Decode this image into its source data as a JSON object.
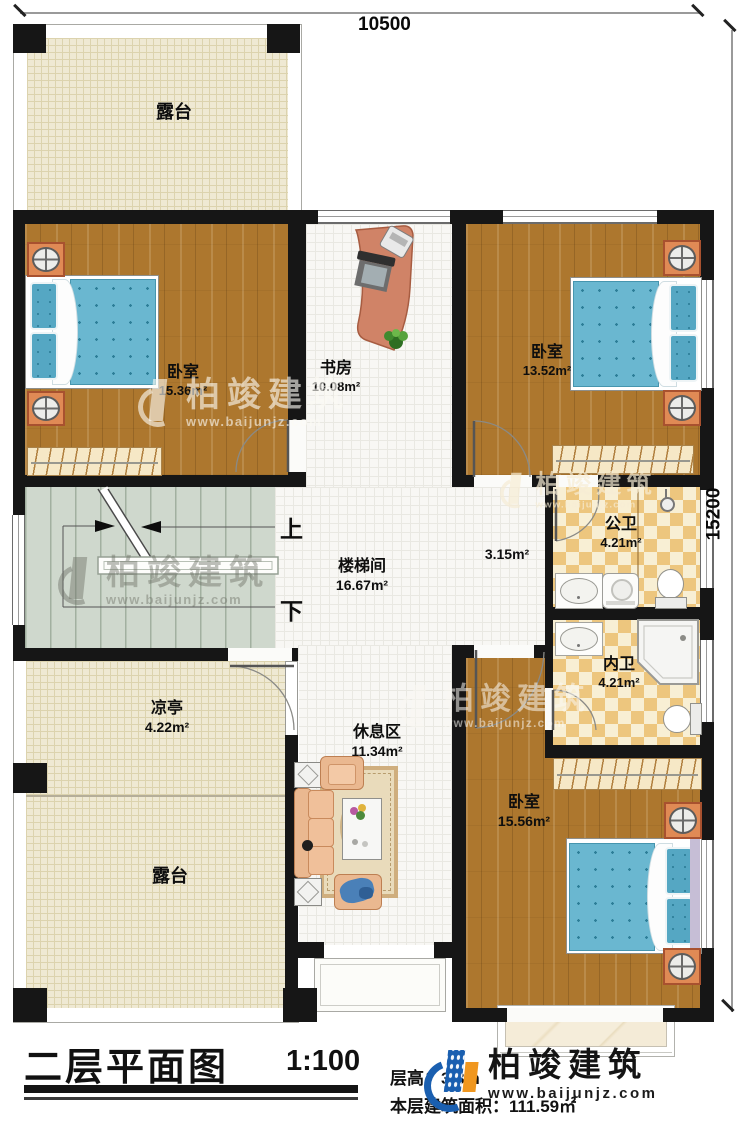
{
  "dimensions": {
    "top": "10500",
    "right": "15200"
  },
  "stairs": {
    "up": "上",
    "down": "下"
  },
  "rooms": {
    "terrace_top": {
      "name": "露台"
    },
    "bedroom_tl": {
      "name": "卧室",
      "area": "15.36m²"
    },
    "study": {
      "name": "书房",
      "area": "10.08m²"
    },
    "bedroom_tr": {
      "name": "卧室",
      "area": "13.52m²"
    },
    "stair_hall": {
      "name": "楼梯间",
      "area": "16.67m²"
    },
    "corridor": {
      "area": "3.15m²"
    },
    "public_bath": {
      "name": "公卫",
      "area": "4.21m²"
    },
    "private_bath": {
      "name": "内卫",
      "area": "4.21m²"
    },
    "pavilion": {
      "name": "凉亭",
      "area": "4.22m²"
    },
    "rest_area": {
      "name": "休息区",
      "area": "11.34m²"
    },
    "bedroom_br": {
      "name": "卧室",
      "area": "15.56m²"
    },
    "terrace_bottom": {
      "name": "露台"
    }
  },
  "title_block": {
    "title": "二层平面图",
    "scale": "1:100",
    "floor_height": "层高：3.3m",
    "floor_area": "本层建筑面积：111.59㎡"
  },
  "brand": {
    "name": "柏竣建筑",
    "url": "www.baijunjz.com"
  }
}
